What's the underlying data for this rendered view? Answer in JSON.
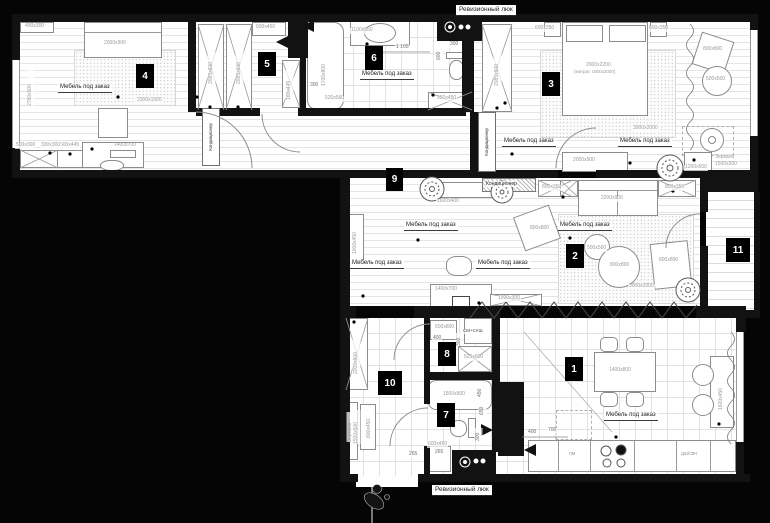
{
  "plan_title": "Floor plan with furniture layout",
  "rooms": [
    "1",
    "2",
    "3",
    "4",
    "5",
    "6",
    "7",
    "8",
    "9",
    "10",
    "11"
  ],
  "labels": {
    "custom_furniture": "Мебель под заказ",
    "revision_hatch": "Ревизионный люк",
    "air_conditioner": "Кондиционер",
    "washer_dryer": "СМ+СУШ",
    "dishwasher_abbr": "пм",
    "oven_micro_abbr": "дш/свч",
    "mirror_word": "Зеркало",
    "bed_size": "2000x2200",
    "bed_mattress": "(матрас 1800x2000)"
  },
  "dims": {
    "450x300": "450x300",
    "2000x900": "2000x900",
    "2300x1500": "2300x1500",
    "2780x500": "2780x500",
    "500x300": "500x300",
    "330x300": "330x300",
    "600x445": "600x445",
    "1400x700": "1400x700",
    "2085x600": "2085x600",
    "600x450": "600x450",
    "160x445": "160x445",
    "1700x800": "1700x800",
    "1100x550": "1100x550",
    "950x450": "950x450",
    "520x560": "520x560",
    "600x350": "600x350",
    "800x800": "800x800",
    "500x500": "500x500",
    "3000x2000": "3000x2000",
    "2000x500": "2000x500",
    "1200x500": "1200x500",
    "1500x500": "1500x500",
    "1600x400": "1600x400",
    "1000x450": "1000x450",
    "1200x300": "1200x300",
    "800x350": "800x350",
    "2200x900": "2200x900",
    "2000x600": "2000x600",
    "800x450": "800x450",
    "525x600": "525x600",
    "500x800": "500x800",
    "1500x900": "1500x900",
    "1400x800": "1400x800",
    "1600x450": "1600x450",
    "d1100": "1 100",
    "d600": "600",
    "d300": "300",
    "d400": "400",
    "d700": "700",
    "d450": "450",
    "d650": "650",
    "d265": "265"
  }
}
